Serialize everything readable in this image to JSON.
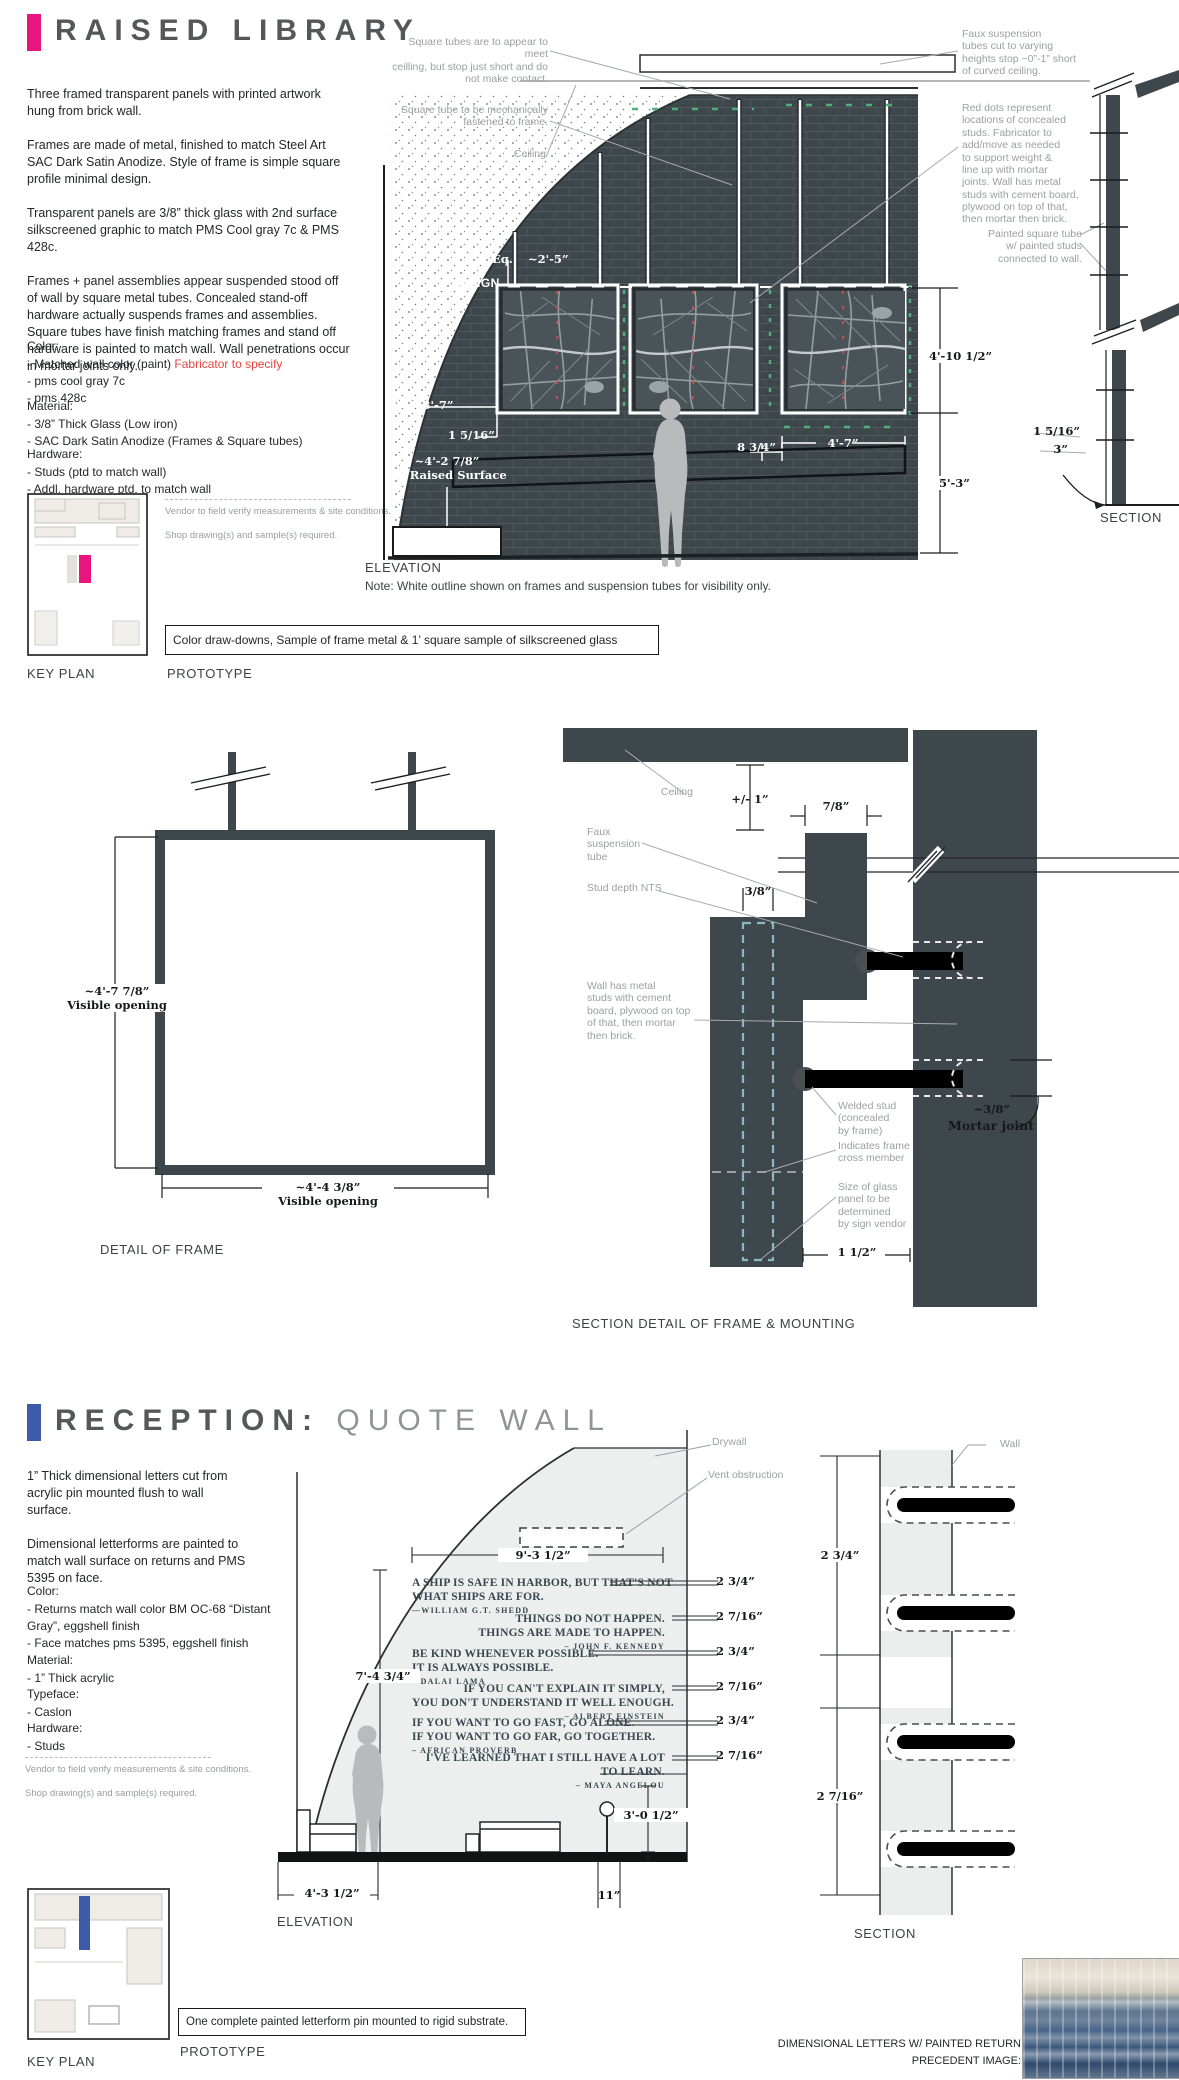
{
  "raised_library": {
    "accent_color": "#E8157F",
    "highlight_color": "#E8443E",
    "title": "RAISED LIBRARY",
    "intro": [
      "Three framed transparent panels with printed artwork hung from brick wall.",
      "Frames are made of metal, finished to match Steel Art SAC Dark Satin Anodize. Style of frame is simple square profile minimal design.",
      "Transparent panels are 3/8” thick glass with 2nd surface silkscreened graphic to match PMS Cool gray 7c & PMS 428c.",
      "Frames + panel assemblies appear suspended stood off of wall by square metal tubes. Concealed stand-off hardware actually suspends frames and assemblies. Square tubes have finish matching frames and stand off hardware is painted to match wall. Wall penetrations occur in mortar joints only."
    ],
    "color_heading": "Color:",
    "color_item1_prefix": "- Matched wall color (paint) ",
    "color_item1_highlight": "Fabricator to specify",
    "color_items": [
      "- pms cool gray 7c",
      "- pms 428c"
    ],
    "material_heading": "Material:",
    "material_items": [
      "- 3/8” Thick Glass (Low iron)",
      "- SAC Dark Satin Anodize (Frames & Square tubes)"
    ],
    "hardware_heading": "Hardware:",
    "hardware_items": [
      "- Studs (ptd to match wall)",
      "- Addl. hardware ptd. to match wall"
    ],
    "vendor_note_1": "Vendor to field verify measurements & site conditions.",
    "vendor_note_2": "Shop drawing(s) and sample(s) required.",
    "key_plan_label": "KEY PLAN",
    "prototype_label": "PROTOTYPE",
    "prototype_box": "Color draw-downs, Sample of frame metal & 1’ square sample of silkscreened glass",
    "elevation_label": "ELEVATION",
    "elevation_note": "Note: White outline shown on frames and suspension tubes for visibility only.",
    "section_label": "SECTION",
    "ann_tubes_meet": "Square tubes are to appear to meet\nceilling, but stop just short and do\nnot make contact.",
    "ann_tube_fastened": "Square tube to be mechanically\nfastened to frame.",
    "ann_ceiling": "Ceiling",
    "ann_faux": "Faux suspension\ntubes cut to varying\nheights stop ~0”-1” short\nof curved ceiling.",
    "ann_red_dots": "Red dots represent\nlocations of concealed\nstuds. Fabricator to\nadd/move as needed\nto support weight &\nline up with mortar\njoints. Wall has metal\nstuds with cement board,\nplywood on top of that,\nthen mortar then brick.",
    "ann_painted_tube": "Painted square tube\nw/ painted studs\nconnected to wall.",
    "dims": {
      "eq": "Eq.",
      "tube_gap": "~2'-5”",
      "align": "ALIGN",
      "left_offset": "3'-7”",
      "standoff": "1 5/16”",
      "raised_height": "~4'-2 7/8”",
      "raised_label": "On Raised Surface",
      "panel_gap": "8 3/4”",
      "panel_width": "4'-7”",
      "panel_height": "4'-10 1/2”",
      "floor_height": "5'-3”",
      "section_standoff": "1 5/16”",
      "section_depth": "3”"
    }
  },
  "frame_detail": {
    "height_dim": "~4'-7 7/8”",
    "height_label": "Visible opening",
    "width_dim": "~4'-4 3/8”",
    "width_label": "Visible opening",
    "label": "DETAIL OF FRAME"
  },
  "mount_detail": {
    "label": "SECTION DETAIL OF FRAME & MOUNTING",
    "ann_ceiling": "Ceiling",
    "dim_gap": "+/- 1”",
    "dim_tube": "7/8”",
    "ann_faux_tube": "Faux\nsuspension\ntube",
    "ann_stud_depth": "Stud depth NTS",
    "dim_glass": "3/8”",
    "ann_wall": "Wall has metal\nstuds with cement\nboard, plywood on top\nof that, then mortar\nthen brick.",
    "ann_welded_stud": "Welded stud\n(concealed\nby frame)",
    "ann_cross_member": "Indicates frame\ncross member",
    "ann_glass_size": "Size of glass\npanel to be\ndetermined\nby sign vendor",
    "dim_standoff": "1 1/2”",
    "dim_mortar": "~3/8”",
    "mortar_label": "Mortar joint"
  },
  "quote_wall": {
    "accent_color": "#3D5BA9",
    "title_primary": "RECEPTION:",
    "title_secondary": "QUOTE WALL",
    "intro": [
      "1” Thick dimensional letters cut from acrylic pin mounted flush to wall surface.",
      "Dimensional letterforms are painted to match wall surface on returns and PMS 5395 on face."
    ],
    "color_heading": "Color:",
    "color_items": [
      "- Returns match wall color BM OC-68 “Distant Gray”, eggshell finish",
      "- Face matches pms 5395, eggshell finish"
    ],
    "material_heading": "Material:",
    "material_items": [
      "- 1” Thick acrylic"
    ],
    "typeface_heading": "Typeface:",
    "typeface_items": [
      "- Caslon"
    ],
    "hardware_heading": "Hardware:",
    "hardware_items": [
      "- Studs"
    ],
    "vendor_note_1": "Vendor to field verify measurements & site conditions.",
    "vendor_note_2": "Shop drawing(s) and sample(s) required.",
    "ann_drywall": "Drywall",
    "ann_vent": "Vent obstruction",
    "ann_wall": "Wall",
    "quotes": [
      {
        "line1": "A SHIP IS SAFE IN HARBOR, BUT THAT'S NOT",
        "line2": "WHAT SHIPS ARE FOR.",
        "author": "—WILLIAM  G.T.  SHEDD",
        "height": "2 3/4”"
      },
      {
        "line1": "THINGS DO NOT HAPPEN.",
        "line2": "THINGS ARE MADE TO HAPPEN.",
        "author": "– JOHN  F.  KENNEDY",
        "height": "2 7/16”"
      },
      {
        "line1": "BE KIND WHENEVER POSSIBLE.",
        "line2": "IT IS ALWAYS POSSIBLE.",
        "author": "– DALAI  LAMA",
        "height": "2 3/4”"
      },
      {
        "line1": "IF YOU CAN'T EXPLAIN IT SIMPLY,",
        "line2": "YOU DON'T UNDERSTAND IT WELL ENOUGH.",
        "author": "– ALBERT  EINSTEIN",
        "height": "2 7/16”"
      },
      {
        "line1": "IF YOU WANT TO GO FAST, GO ALONE.",
        "line2": "IF YOU WANT TO GO FAR, GO TOGETHER.",
        "author": "– AFRICAN  PROVERB",
        "height": "2 3/4”"
      },
      {
        "line1": "I'VE LEARNED THAT I STILL HAVE A LOT",
        "line2": "TO LEARN.",
        "author": "– MAYA  ANGELOU",
        "height": "2 7/16”"
      }
    ],
    "dims": {
      "wall_width": "9'-3 1/2”",
      "text_height": "7'-4 3/4”",
      "left_width": "4'-3 1/2”",
      "right_width": "11”",
      "bottom_height": "3'-0 1/2”",
      "section_top": "2 3/4”",
      "section_bottom": "2 7/16”"
    },
    "elevation_label": "ELEVATION",
    "section_label": "SECTION",
    "key_plan_label": "KEY PLAN",
    "prototype_label": "PROTOTYPE",
    "prototype_box": "One complete painted letterform pin mounted to rigid substrate.",
    "precedent_line1": "DIMENSIONAL LETTERS W/ PAINTED RETURN",
    "precedent_line2": "PRECEDENT IMAGE:"
  }
}
